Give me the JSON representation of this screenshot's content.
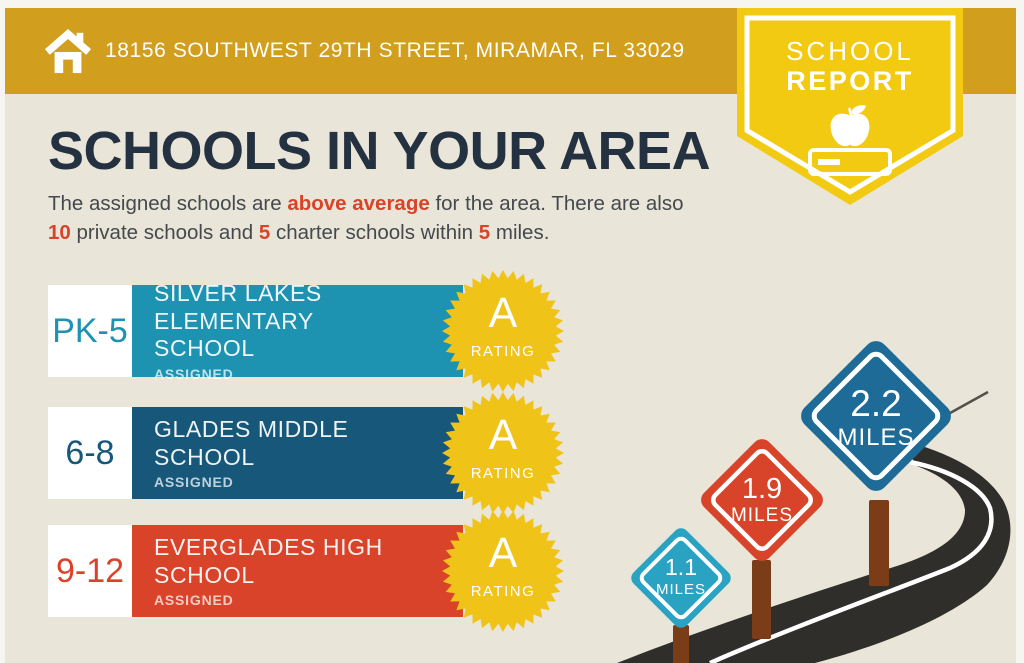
{
  "header": {
    "address": "18156 SOUTHWEST 29TH STREET, MIRAMAR, FL 33029"
  },
  "ribbon": {
    "line1": "SCHOOL",
    "line2": "REPORT"
  },
  "title": "SCHOOLS IN YOUR AREA",
  "intro": {
    "segments": [
      {
        "text": "The assigned schools are "
      },
      {
        "text": "above average",
        "em": true
      },
      {
        "text": " for the area. There are also "
      },
      {
        "text": "10",
        "em": true
      },
      {
        "text": " private schools and "
      },
      {
        "text": "5",
        "em": true
      },
      {
        "text": " charter schools within "
      },
      {
        "text": "5",
        "em": true
      },
      {
        "text": " miles."
      }
    ]
  },
  "schools": [
    {
      "grades": "PK-5",
      "name": "SILVER LAKES ELEMENTARY SCHOOL",
      "status": "ASSIGNED",
      "rating": "A",
      "rating_label": "RATING",
      "color": "#1e93b1"
    },
    {
      "grades": "6-8",
      "name": "GLADES MIDDLE SCHOOL",
      "status": "ASSIGNED",
      "rating": "A",
      "rating_label": "RATING",
      "color": "#17587a"
    },
    {
      "grades": "9-12",
      "name": "EVERGLADES HIGH SCHOOL",
      "status": "ASSIGNED",
      "rating": "A",
      "rating_label": "RATING",
      "color": "#d8432a"
    }
  ],
  "distances": [
    {
      "value": "1.1",
      "unit": "MILES",
      "color": "#2aa3c3"
    },
    {
      "value": "1.9",
      "unit": "MILES",
      "color": "#d8442a"
    },
    {
      "value": "2.2",
      "unit": "MILES",
      "color": "#1d6b96"
    }
  ],
  "theme": {
    "banner_gold": "#d19e1d",
    "ribbon_yellow": "#f3ca12",
    "badge_yellow": "#f0c319",
    "background_beige": "#e9e5d9",
    "heading_navy": "#243140",
    "accent_orange": "#d8432a",
    "road_charcoal": "#302e2b",
    "post_brown": "#7b3d17"
  }
}
